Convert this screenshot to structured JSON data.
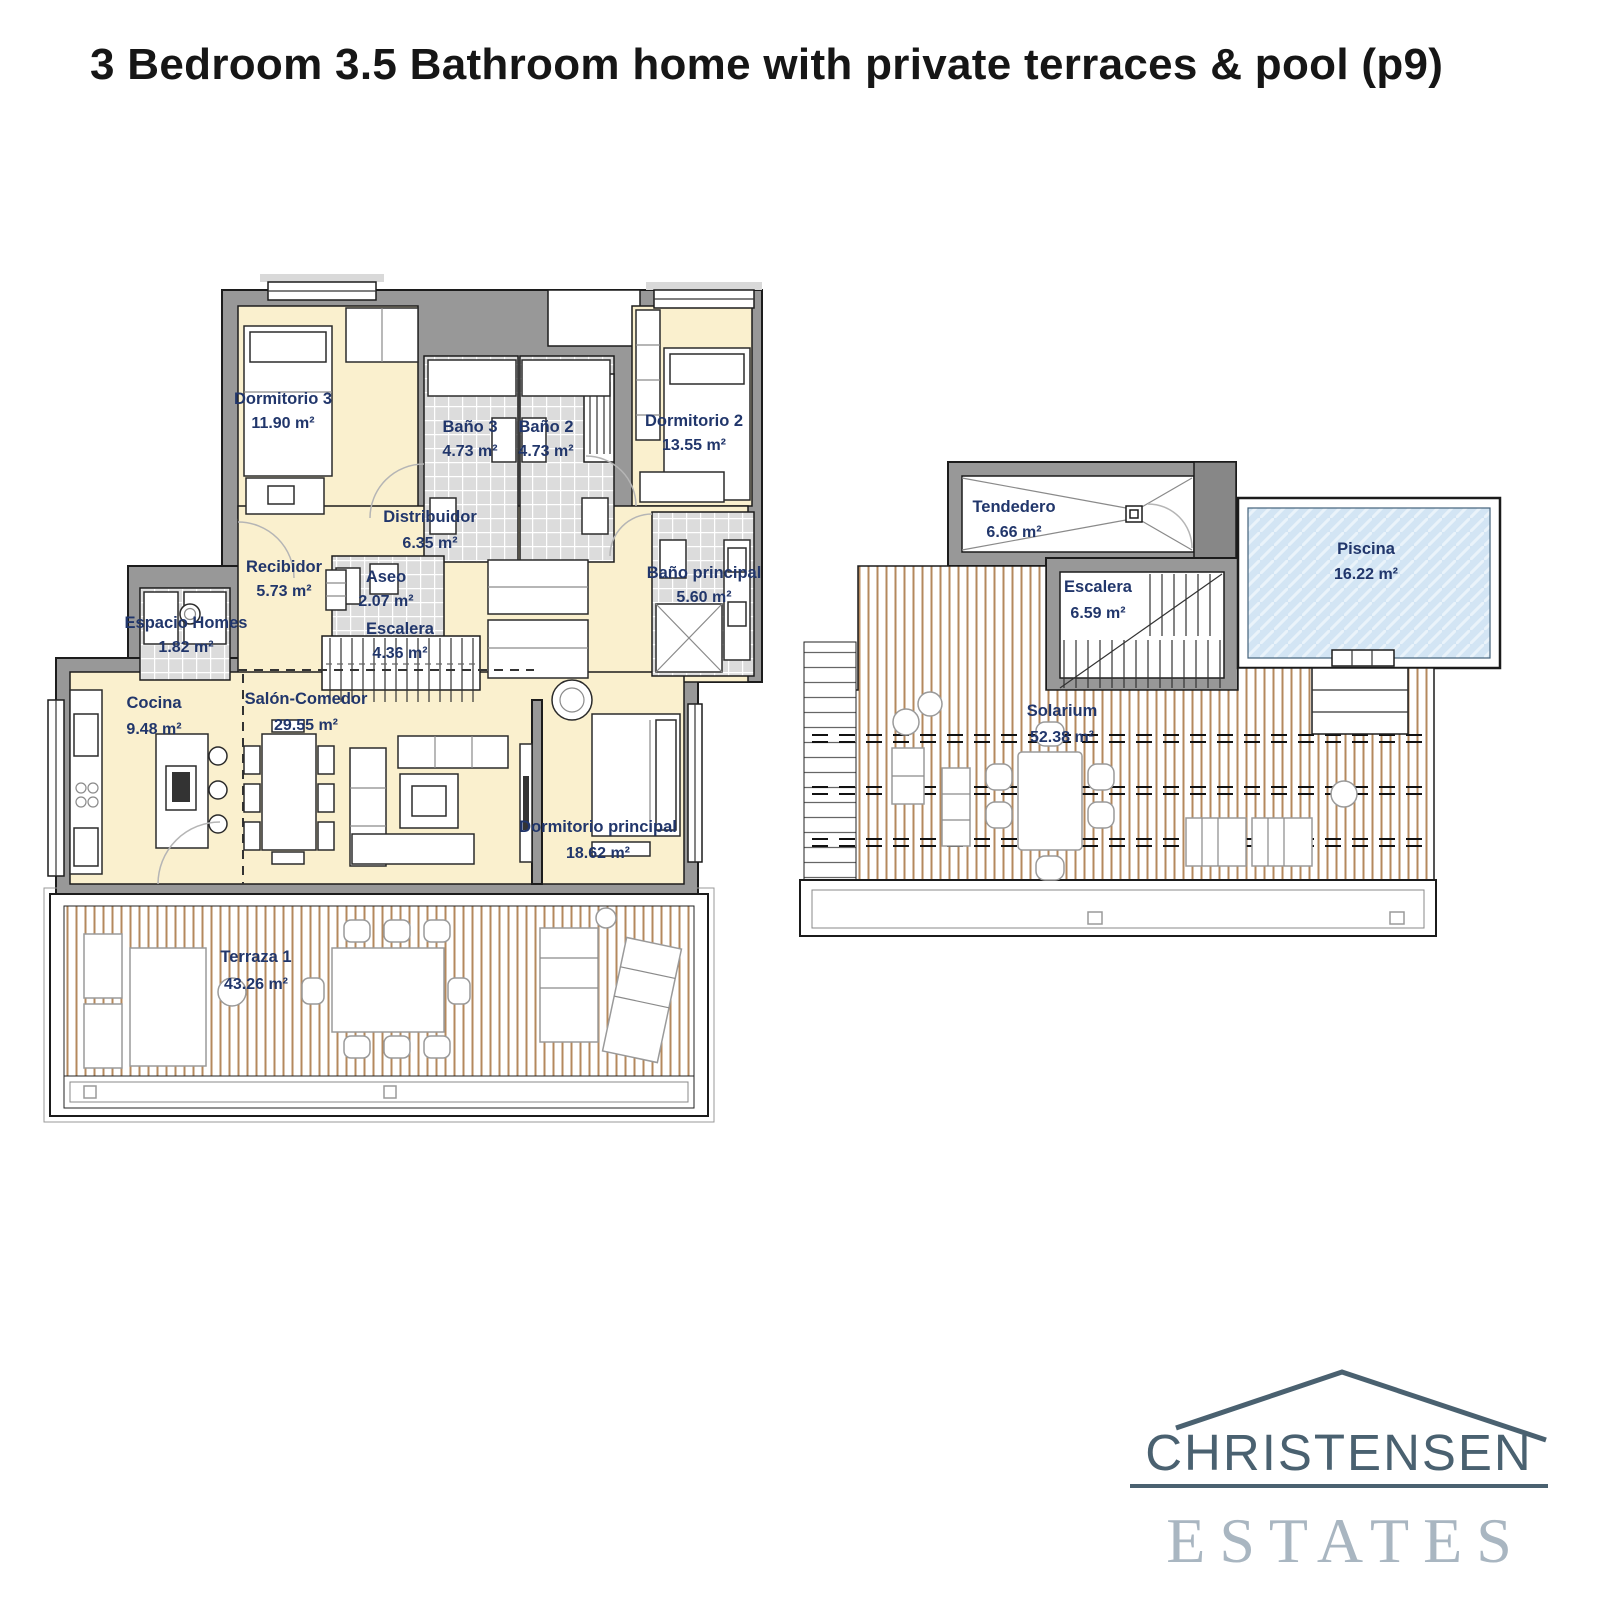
{
  "title": "3 Bedroom 3.5 Bathroom home with private terraces & pool (p9)",
  "floor_main": {
    "dormitorio3": {
      "name": "Dormitorio 3",
      "area": "11.90 m²"
    },
    "bano3": {
      "name": "Baño 3",
      "area": "4.73 m²"
    },
    "bano2": {
      "name": "Baño 2",
      "area": "4.73 m²"
    },
    "dormitorio2": {
      "name": "Dormitorio 2",
      "area": "13.55 m²"
    },
    "distribuidor": {
      "name": "Distribuidor",
      "area": "6.35 m²"
    },
    "recibidor": {
      "name": "Recibidor",
      "area": "5.73 m²"
    },
    "aseo": {
      "name": "Aseo",
      "area": "2.07 m²"
    },
    "escalera": {
      "name": "Escalera",
      "area": "4.36 m²"
    },
    "bano_principal": {
      "name": "Baño principal",
      "area": "5.60 m²"
    },
    "espacio_homes": {
      "name": "Espacio Homes",
      "area": "1.82 m²"
    },
    "cocina": {
      "name": "Cocina",
      "area": "9.48 m²"
    },
    "salon_comedor": {
      "name": "Salón-Comedor",
      "area": "29.55 m²"
    },
    "dormitorio_principal": {
      "name": "Dormitorio principal",
      "area": "18.62 m²"
    },
    "terraza1": {
      "name": "Terraza 1",
      "area": "43.26 m²"
    }
  },
  "floor_roof": {
    "tendedero": {
      "name": "Tendedero",
      "area": "6.66 m²"
    },
    "escalera": {
      "name": "Escalera",
      "area": "6.59 m²"
    },
    "piscina": {
      "name": "Piscina",
      "area": "16.22 m²"
    },
    "solarium": {
      "name": "Solarium",
      "area": "52.38 m²"
    }
  },
  "logo": {
    "line1": "CHRISTENSEN",
    "line2": "ESTATES"
  },
  "colors": {
    "room_fill": "#FAF0CE",
    "wall": "#989898",
    "tile": "#DCDCDC",
    "deck_stripe": "#B4895E",
    "pool": "#D3E5F4",
    "label": "#21366B",
    "logo_primary": "#4A6170",
    "logo_secondary": "#A9B6C1",
    "title": "#161616"
  }
}
